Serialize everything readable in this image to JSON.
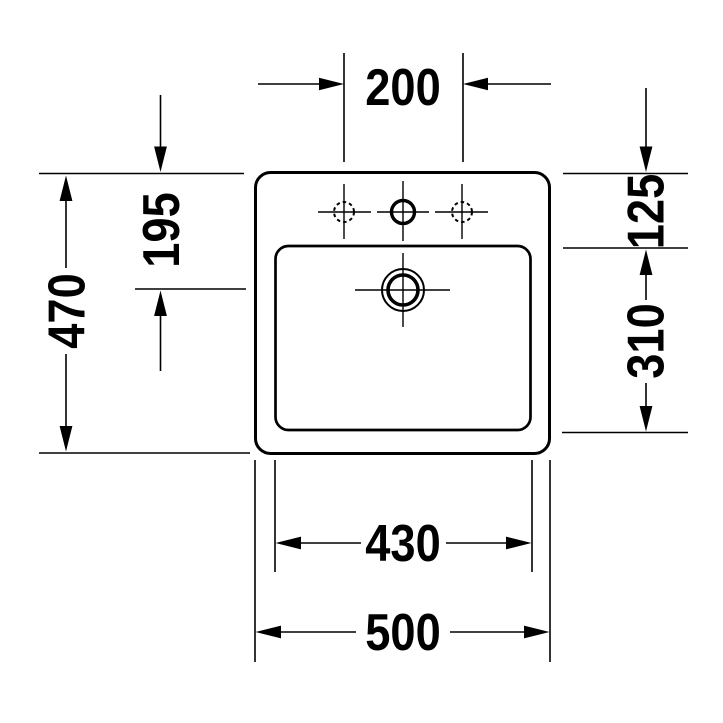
{
  "drawing": {
    "type": "washbasin technical drawing, plan view",
    "background_color": "#ffffff",
    "line_color": "#000000",
    "labels": {
      "tap_hole_spacing": "200",
      "rim_to_drain_center": "195",
      "overall_depth": "470",
      "rim_to_basin_edge": "125",
      "basin_inner_depth": "310",
      "basin_inner_width": "430",
      "overall_width": "500"
    }
  }
}
